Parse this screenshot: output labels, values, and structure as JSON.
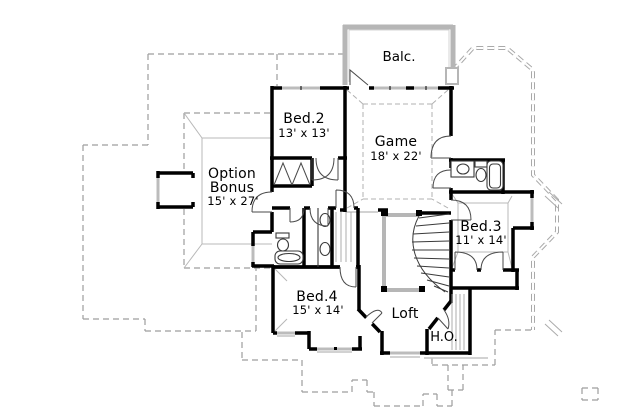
{
  "drawing": {
    "kind": "second-floor-plan"
  },
  "rooms": {
    "balcony": {
      "label": "Balc."
    },
    "bed2": {
      "label": "Bed.2",
      "dims": "13' x 13'"
    },
    "game": {
      "label": "Game",
      "dims": "18' x 22'"
    },
    "option_bonus": {
      "line1": "Option",
      "line2": "Bonus",
      "dims": "15' x 27'"
    },
    "bed3": {
      "label": "Bed.3",
      "dims": "11' x 14'"
    },
    "bed4": {
      "label": "Bed.4",
      "dims": "15' x 14'"
    },
    "loft": {
      "label": "Loft"
    },
    "ho": {
      "label": "H.O."
    }
  },
  "colors": {
    "wall": "#000000",
    "porch_wall": "#b6b6b6",
    "roof_dashed": "#9d9d9d",
    "thin_line": "#b8b8b8",
    "window": "#bcbcbc",
    "text": "#000000",
    "background": "#ffffff"
  }
}
